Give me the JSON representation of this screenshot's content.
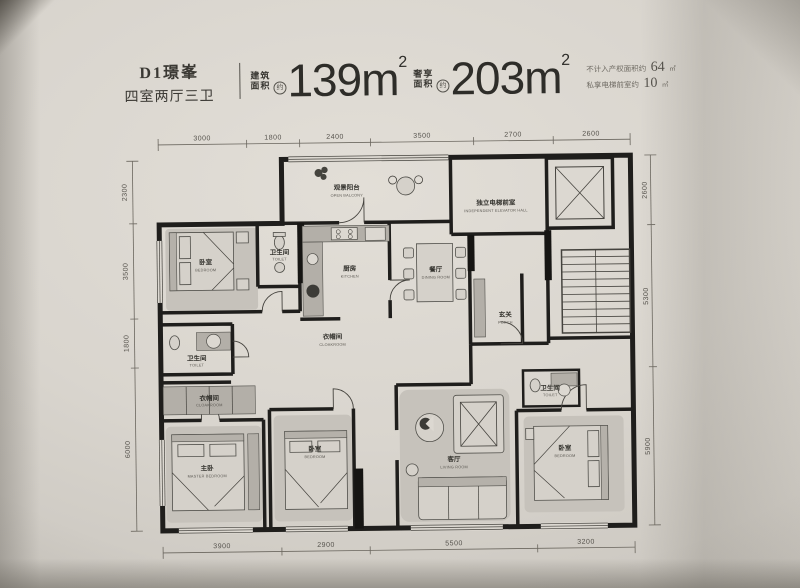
{
  "header": {
    "plan_name": "D1璟峯",
    "layout_summary": "四室两厅三卫",
    "areas": [
      {
        "label_line1": "建筑",
        "label_line2": "面积",
        "approx": "约",
        "value": "139m",
        "sup": "2"
      },
      {
        "label_line1": "奢享",
        "label_line2": "面积",
        "approx": "约",
        "value": "203m",
        "sup": "2"
      }
    ],
    "notes": [
      {
        "label": "不计入产权面积约",
        "value": "64",
        "unit": "㎡"
      },
      {
        "label": "私享电梯前室约",
        "value": "10",
        "unit": "㎡"
      }
    ]
  },
  "dimensions": {
    "top": [
      "3000",
      "1800",
      "2400",
      "3500",
      "2700",
      "2600"
    ],
    "bottom": [
      "3900",
      "2900",
      "5500",
      "3200"
    ],
    "left": [
      "2300",
      "3500",
      "1800",
      "6000"
    ],
    "right": [
      "2600",
      "5300",
      "5900"
    ]
  },
  "rooms": [
    {
      "cn": "观景阳台",
      "en": "OPEN BALCONY"
    },
    {
      "cn": "卧室",
      "en": "BEDROOM"
    },
    {
      "cn": "卫生间",
      "en": "TOILET"
    },
    {
      "cn": "厨房",
      "en": "KITCHEN"
    },
    {
      "cn": "餐厅",
      "en": "DINING ROOM"
    },
    {
      "cn": "独立电梯前室",
      "en": "INDEPENDENT ELEVATOR HALL"
    },
    {
      "cn": "玄关",
      "en": "PORCH"
    },
    {
      "cn": "衣帽间",
      "en": "CLOAKROOM"
    },
    {
      "cn": "卫生间",
      "en": "TOILET"
    },
    {
      "cn": "衣帽间",
      "en": "CLOAKROOM"
    },
    {
      "cn": "主卧",
      "en": "MASTER BEDROOM"
    },
    {
      "cn": "卧室",
      "en": "BEDROOM"
    },
    {
      "cn": "客厅",
      "en": "LIVING ROOM"
    },
    {
      "cn": "卫生间",
      "en": "TOILET"
    },
    {
      "cn": "卧室",
      "en": "BEDROOM"
    }
  ]
}
